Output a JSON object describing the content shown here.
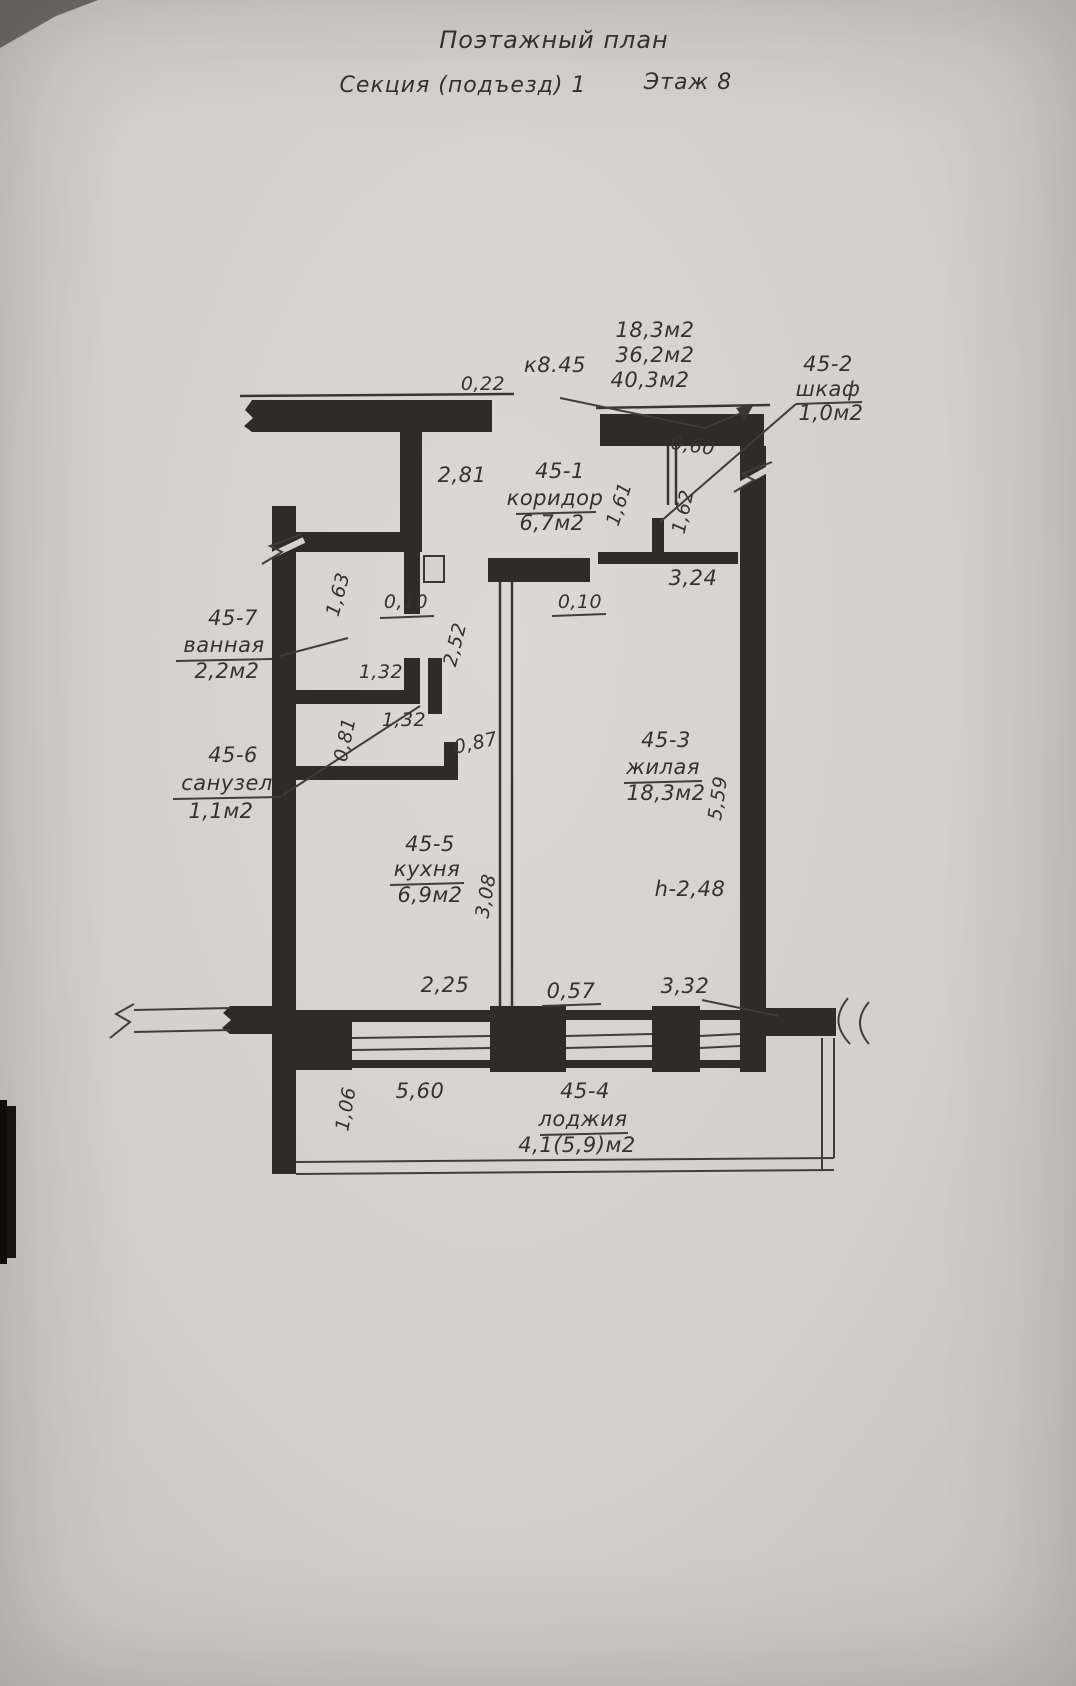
{
  "document": {
    "title": "Поэтажный план",
    "section": "Секция (подъезд) 1",
    "floor": "Этаж 8",
    "apartment_ref": "к8.45",
    "area_summary": [
      "18,3м2",
      "36,2м2",
      "40,3м2"
    ],
    "ceiling_height": "h-2,48"
  },
  "rooms": [
    {
      "id": "45-1",
      "name": "коридор",
      "area": "6,7м2"
    },
    {
      "id": "45-2",
      "name": "шкаф",
      "area": "1,0м2"
    },
    {
      "id": "45-3",
      "name": "жилая",
      "area": "18,3м2"
    },
    {
      "id": "45-4",
      "name": "лоджия",
      "area": "4,1(5,9)м2"
    },
    {
      "id": "45-5",
      "name": "кухня",
      "area": "6,9м2"
    },
    {
      "id": "45-6",
      "name": "санузел",
      "area": "1,1м2"
    },
    {
      "id": "45-7",
      "name": "ванная",
      "area": "2,2м2"
    }
  ],
  "dims": {
    "top_wall_offset": "0,22",
    "corridor_width": "2,81",
    "closet_width": "0,60",
    "closet_depth_left": "1,61",
    "closet_depth_right": "1,62",
    "corridor_to_wall": "3,24",
    "living_wall_notch": "0,10",
    "bath_door_wall": "0,10",
    "bath_length": "1,63",
    "kitchen_strip": "2,52",
    "bath_width_upper": "1,32",
    "bath_width_lower": "1,32",
    "kitchen_door": "0,87",
    "wc_length": "0,81",
    "living_length": "5,59",
    "kitchen_length": "3,08",
    "kitchen_window": "2,25",
    "balcony_door": "0,57",
    "living_window": "3,32",
    "loggia_width": "5,60",
    "loggia_depth": "1,06"
  },
  "colors": {
    "paper": "#d6d3cf",
    "ink": "#2e2b28"
  }
}
